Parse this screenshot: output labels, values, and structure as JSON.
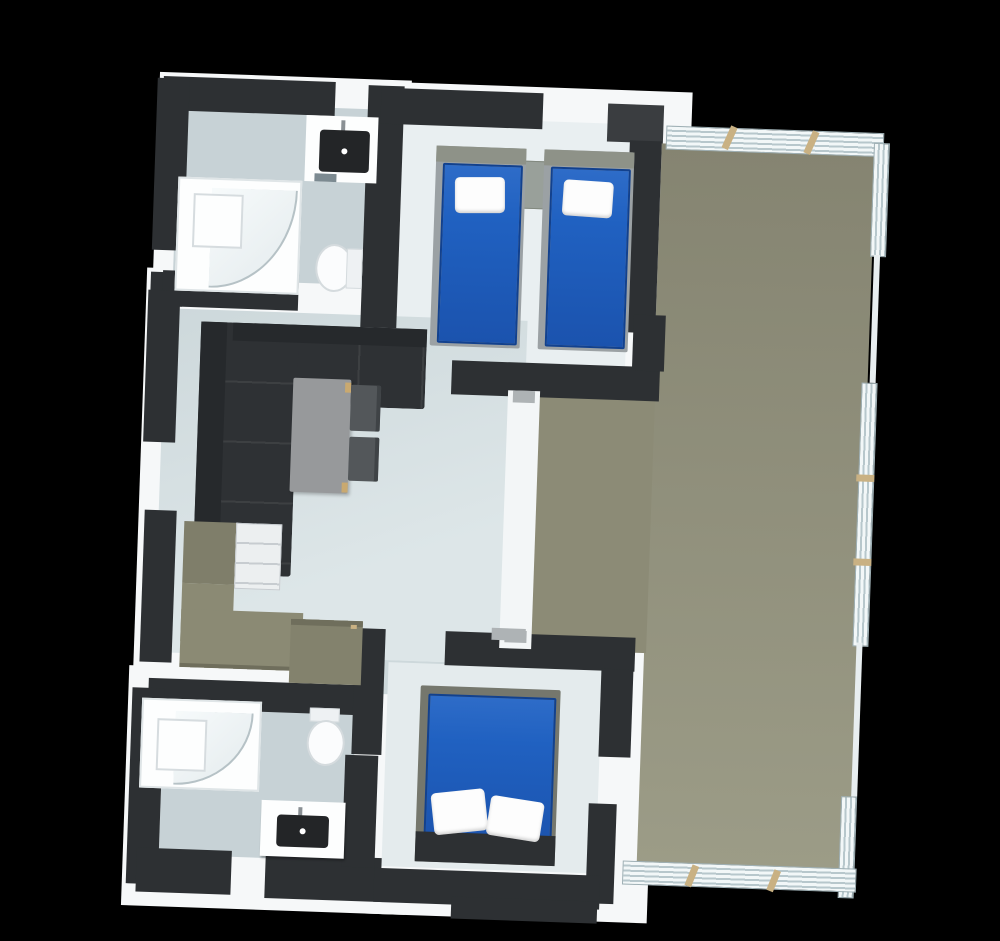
{
  "scene": {
    "type": "3d-floor-plan-top-view",
    "background": "#000000",
    "description": "Isometric top-down render of a small home: two bathrooms with corner showers, a twin bedroom, a double bedroom, open living room with corner sofa, dining table and kitchenette, and a large side terrace with slatted railing."
  },
  "palette": {
    "wall": "#2d3033",
    "wall_light": "#3a3d40",
    "white_top": "#f6f8f9",
    "floor_bath": "#c7d2d6",
    "floor_living": "#cdd8db",
    "floor_bed_top": "#e9eff1",
    "floor_bed_bottom": "#e4ebed",
    "terrace_a": "#858471",
    "terrace_b": "#9c9c87",
    "terrace_notch": "#8c8b76",
    "bed_blue": "#2061c1",
    "bed_frame": "#9ba1a4",
    "bed_headboard": "#8e9288",
    "double_frame": "#75776d",
    "pillow": "#fdfdfd",
    "sofa": "#2e3134",
    "sofa_dark": "#26292c",
    "table": "#97999b",
    "chair": "#53575a",
    "accent_tan": "#c9a970",
    "kitchen": "#8b8a74",
    "kitchen_dark": "#7f7e6a",
    "island": "#83826d",
    "fixture": "#232527",
    "porcelain": "#fbfcfd",
    "post_tan": "#c9b183",
    "handle_gray": "#aeb3b5",
    "divider_white": "#f3f6f7"
  },
  "rooms": [
    {
      "id": "bathroom-top",
      "furniture": [
        "corner-shower",
        "washbasin",
        "toilet",
        "towel-rail"
      ]
    },
    {
      "id": "bedroom-twin",
      "furniture": [
        "twin-bed",
        "twin-bed",
        "nightstand"
      ]
    },
    {
      "id": "living-kitchen",
      "furniture": [
        "corner-sofa",
        "dining-table",
        "chair",
        "chair",
        "tall-cabinet",
        "kitchen-counter",
        "kitchen-island"
      ]
    },
    {
      "id": "bathroom-bottom",
      "furniture": [
        "corner-shower",
        "washbasin",
        "toilet"
      ]
    },
    {
      "id": "bedroom-double",
      "furniture": [
        "double-bed"
      ]
    },
    {
      "id": "terrace",
      "furniture": [
        "slatted-railing"
      ]
    }
  ],
  "counts": {
    "bedrooms": 2,
    "bathrooms": 2,
    "beds": 3,
    "pillows_visible": 4,
    "sliding_doors": 1
  }
}
